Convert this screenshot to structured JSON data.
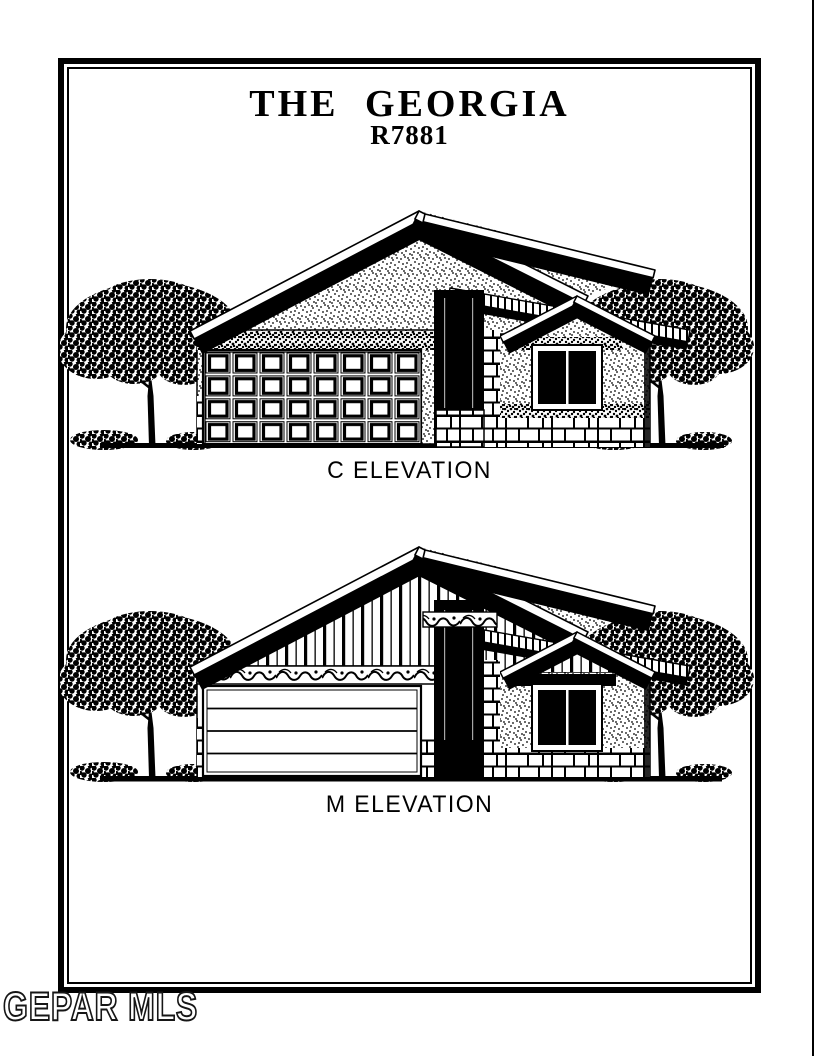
{
  "document": {
    "background": "#ffffff",
    "ink_color": "#000000",
    "title": "THE GEORGIA",
    "model_number": "R7881",
    "watermark": "GEPAR MLS"
  },
  "elevations": [
    {
      "label": "C ELEVATION"
    },
    {
      "label": "M ELEVATION"
    }
  ]
}
